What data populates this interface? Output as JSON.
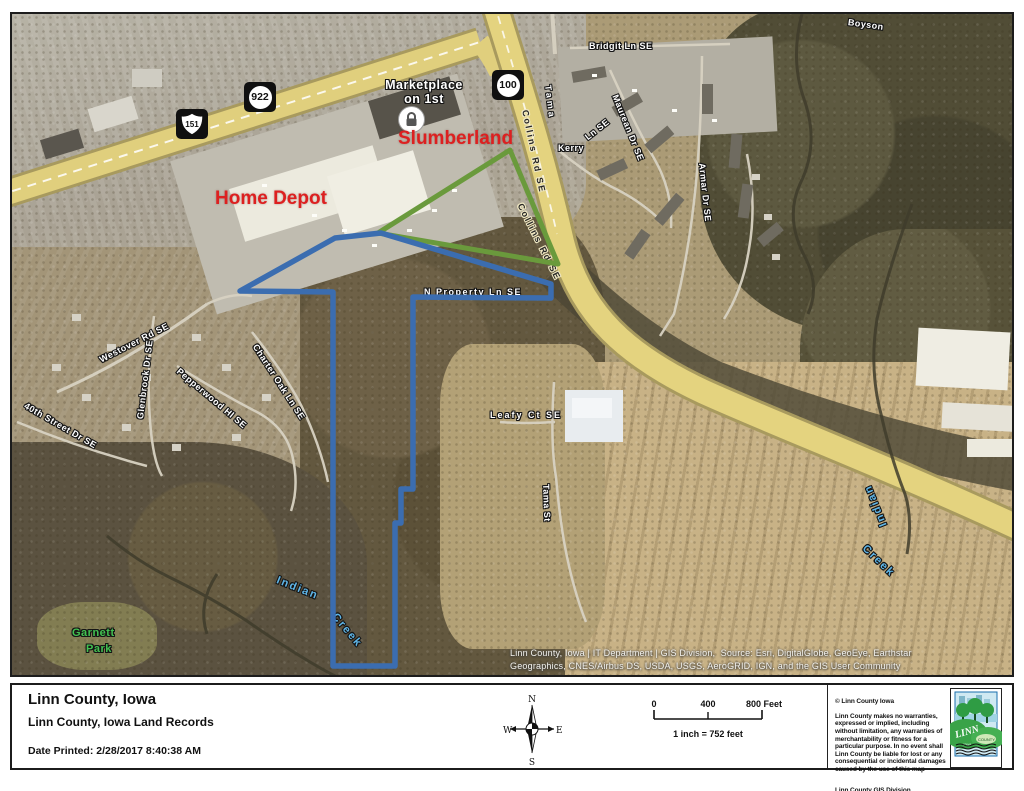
{
  "map": {
    "labels": [
      {
        "t": "Boyson",
        "x": 836,
        "y": 3,
        "r": 8,
        "c": "st"
      },
      {
        "t": "Tama",
        "x": 536,
        "y": 66,
        "r": 83,
        "c": "st",
        "ls": 3
      },
      {
        "t": "Bridgit Ln SE",
        "x": 577,
        "y": 27,
        "r": 0,
        "c": "st"
      },
      {
        "t": "Maurean Dr SE",
        "x": 603,
        "y": 76,
        "r": 68,
        "c": "st"
      },
      {
        "t": "Kerry",
        "x": 546,
        "y": 129,
        "r": 0,
        "c": "st"
      },
      {
        "t": "Ln SE",
        "x": 574,
        "y": 119,
        "r": -38,
        "c": "st"
      },
      {
        "t": "Armar Dr SE",
        "x": 690,
        "y": 144,
        "r": 84,
        "c": "st"
      },
      {
        "t": "Collins Rd SE",
        "x": 513,
        "y": 91,
        "r": 78,
        "c": "blk",
        "ls": 2
      },
      {
        "t": "Collins Rd SE",
        "x": 508,
        "y": 185,
        "r": 63,
        "c": "blk",
        "ls": 2
      },
      {
        "t": "N Property Ln SE",
        "x": 412,
        "y": 273,
        "r": 0,
        "c": "st",
        "ls": 1.5
      },
      {
        "t": "Westover Rd SE",
        "x": 88,
        "y": 341,
        "r": -27,
        "c": "st"
      },
      {
        "t": "Glenbrook Dr SE",
        "x": 128,
        "y": 400,
        "r": -83,
        "c": "st"
      },
      {
        "t": "Pepperwood Hl SE",
        "x": 166,
        "y": 351,
        "r": 40,
        "c": "st"
      },
      {
        "t": "Charter Oak Ln SE",
        "x": 243,
        "y": 326,
        "r": 57,
        "c": "st"
      },
      {
        "t": "40th Street Dr SE",
        "x": 13,
        "y": 386,
        "r": 30,
        "c": "st"
      },
      {
        "t": "Leafy Ct SE",
        "x": 478,
        "y": 396,
        "r": 0,
        "c": "st",
        "ls": 2
      },
      {
        "t": "Tama St",
        "x": 534,
        "y": 465,
        "r": 88,
        "c": "st"
      },
      {
        "t": "Garnett",
        "x": 60,
        "y": 613,
        "r": 0,
        "c": "grn"
      },
      {
        "t": "Park",
        "x": 74,
        "y": 629,
        "r": 0,
        "c": "grn"
      },
      {
        "t": "Indian",
        "x": 265,
        "y": 560,
        "r": 22,
        "c": "blu"
      },
      {
        "t": "Creek",
        "x": 322,
        "y": 595,
        "r": 50,
        "c": "blu"
      },
      {
        "t": "Indian",
        "x": 872,
        "y": 506,
        "r": -112,
        "c": "blu"
      },
      {
        "t": "Creek",
        "x": 852,
        "y": 527,
        "r": 44,
        "c": "blu"
      },
      {
        "t": "Marketplace\non 1st",
        "x": 362,
        "y": 64,
        "r": 0,
        "c": "mkt",
        "w": 100
      },
      {
        "t": "Slumberland",
        "x": 386,
        "y": 114,
        "r": 0,
        "c": "red"
      },
      {
        "t": "Home Depot",
        "x": 203,
        "y": 174,
        "r": 0,
        "c": "red"
      }
    ],
    "shields": [
      {
        "t": "151",
        "kind": "us",
        "x": 164,
        "y": 95
      },
      {
        "t": "922",
        "kind": "circle",
        "x": 232,
        "y": 68
      },
      {
        "t": "100",
        "kind": "circle",
        "x": 480,
        "y": 56
      }
    ],
    "polygons": {
      "parcel_blue_points": "228,277 323,224 369,219 539,270 539,284 401,283 401,475 389,475 389,509 383,509 383,652 321,652 321,278",
      "overlay_green_points": "366,219 498,136 546,250"
    },
    "colors": {
      "parcel_blue": "#3b6db0",
      "overlay_green": "#6a9a3c",
      "label_red": "#dd2020",
      "creek_blue": "#5fb6e8",
      "park_green": "#43c151",
      "road_yellow": "#e4d37f"
    },
    "icons": {
      "lock": "padlock"
    }
  },
  "attribution": {
    "line1": "Linn County, Iowa | IT Department | GIS Division,  Source: Esri, DigitalGlobe, GeoEye, Earthstar",
    "line2": "Geographics, CNES/Airbus DS, USDA, USGS, AeroGRID, IGN, and the GIS User Community"
  },
  "footer": {
    "title": "Linn County, Iowa",
    "subtitle": "Linn County, Iowa Land Records",
    "date_label": "Date Printed:",
    "date_value": "2/28/2017  8:40:38 AM"
  },
  "compass": {
    "n": "N",
    "s": "S",
    "e": "E",
    "w": "W"
  },
  "scalebar": {
    "t0": "0",
    "t400": "400",
    "t800": "800 Feet",
    "ratio": "1 inch = 752 feet"
  },
  "disclaimer": {
    "copyright": "© Linn County Iowa",
    "body": "Linn County makes no warranties,\nexpressed or implied, including\nwithout limitation, any warranties of\nmerchantability or fitness for a\nparticular purpose. In no event shall\nLinn County be liable for lost or any\nconsequential or incidental damages\ncaused by the use of this map",
    "address": "Linn County GIS Division\n1040 26th Ave Ct SW\nCedar Rapids, IA 52404\n(319) 892-5055"
  },
  "logo": {
    "n1": "LINN",
    "n2": "COUNTY",
    "n3": "IOWA"
  }
}
